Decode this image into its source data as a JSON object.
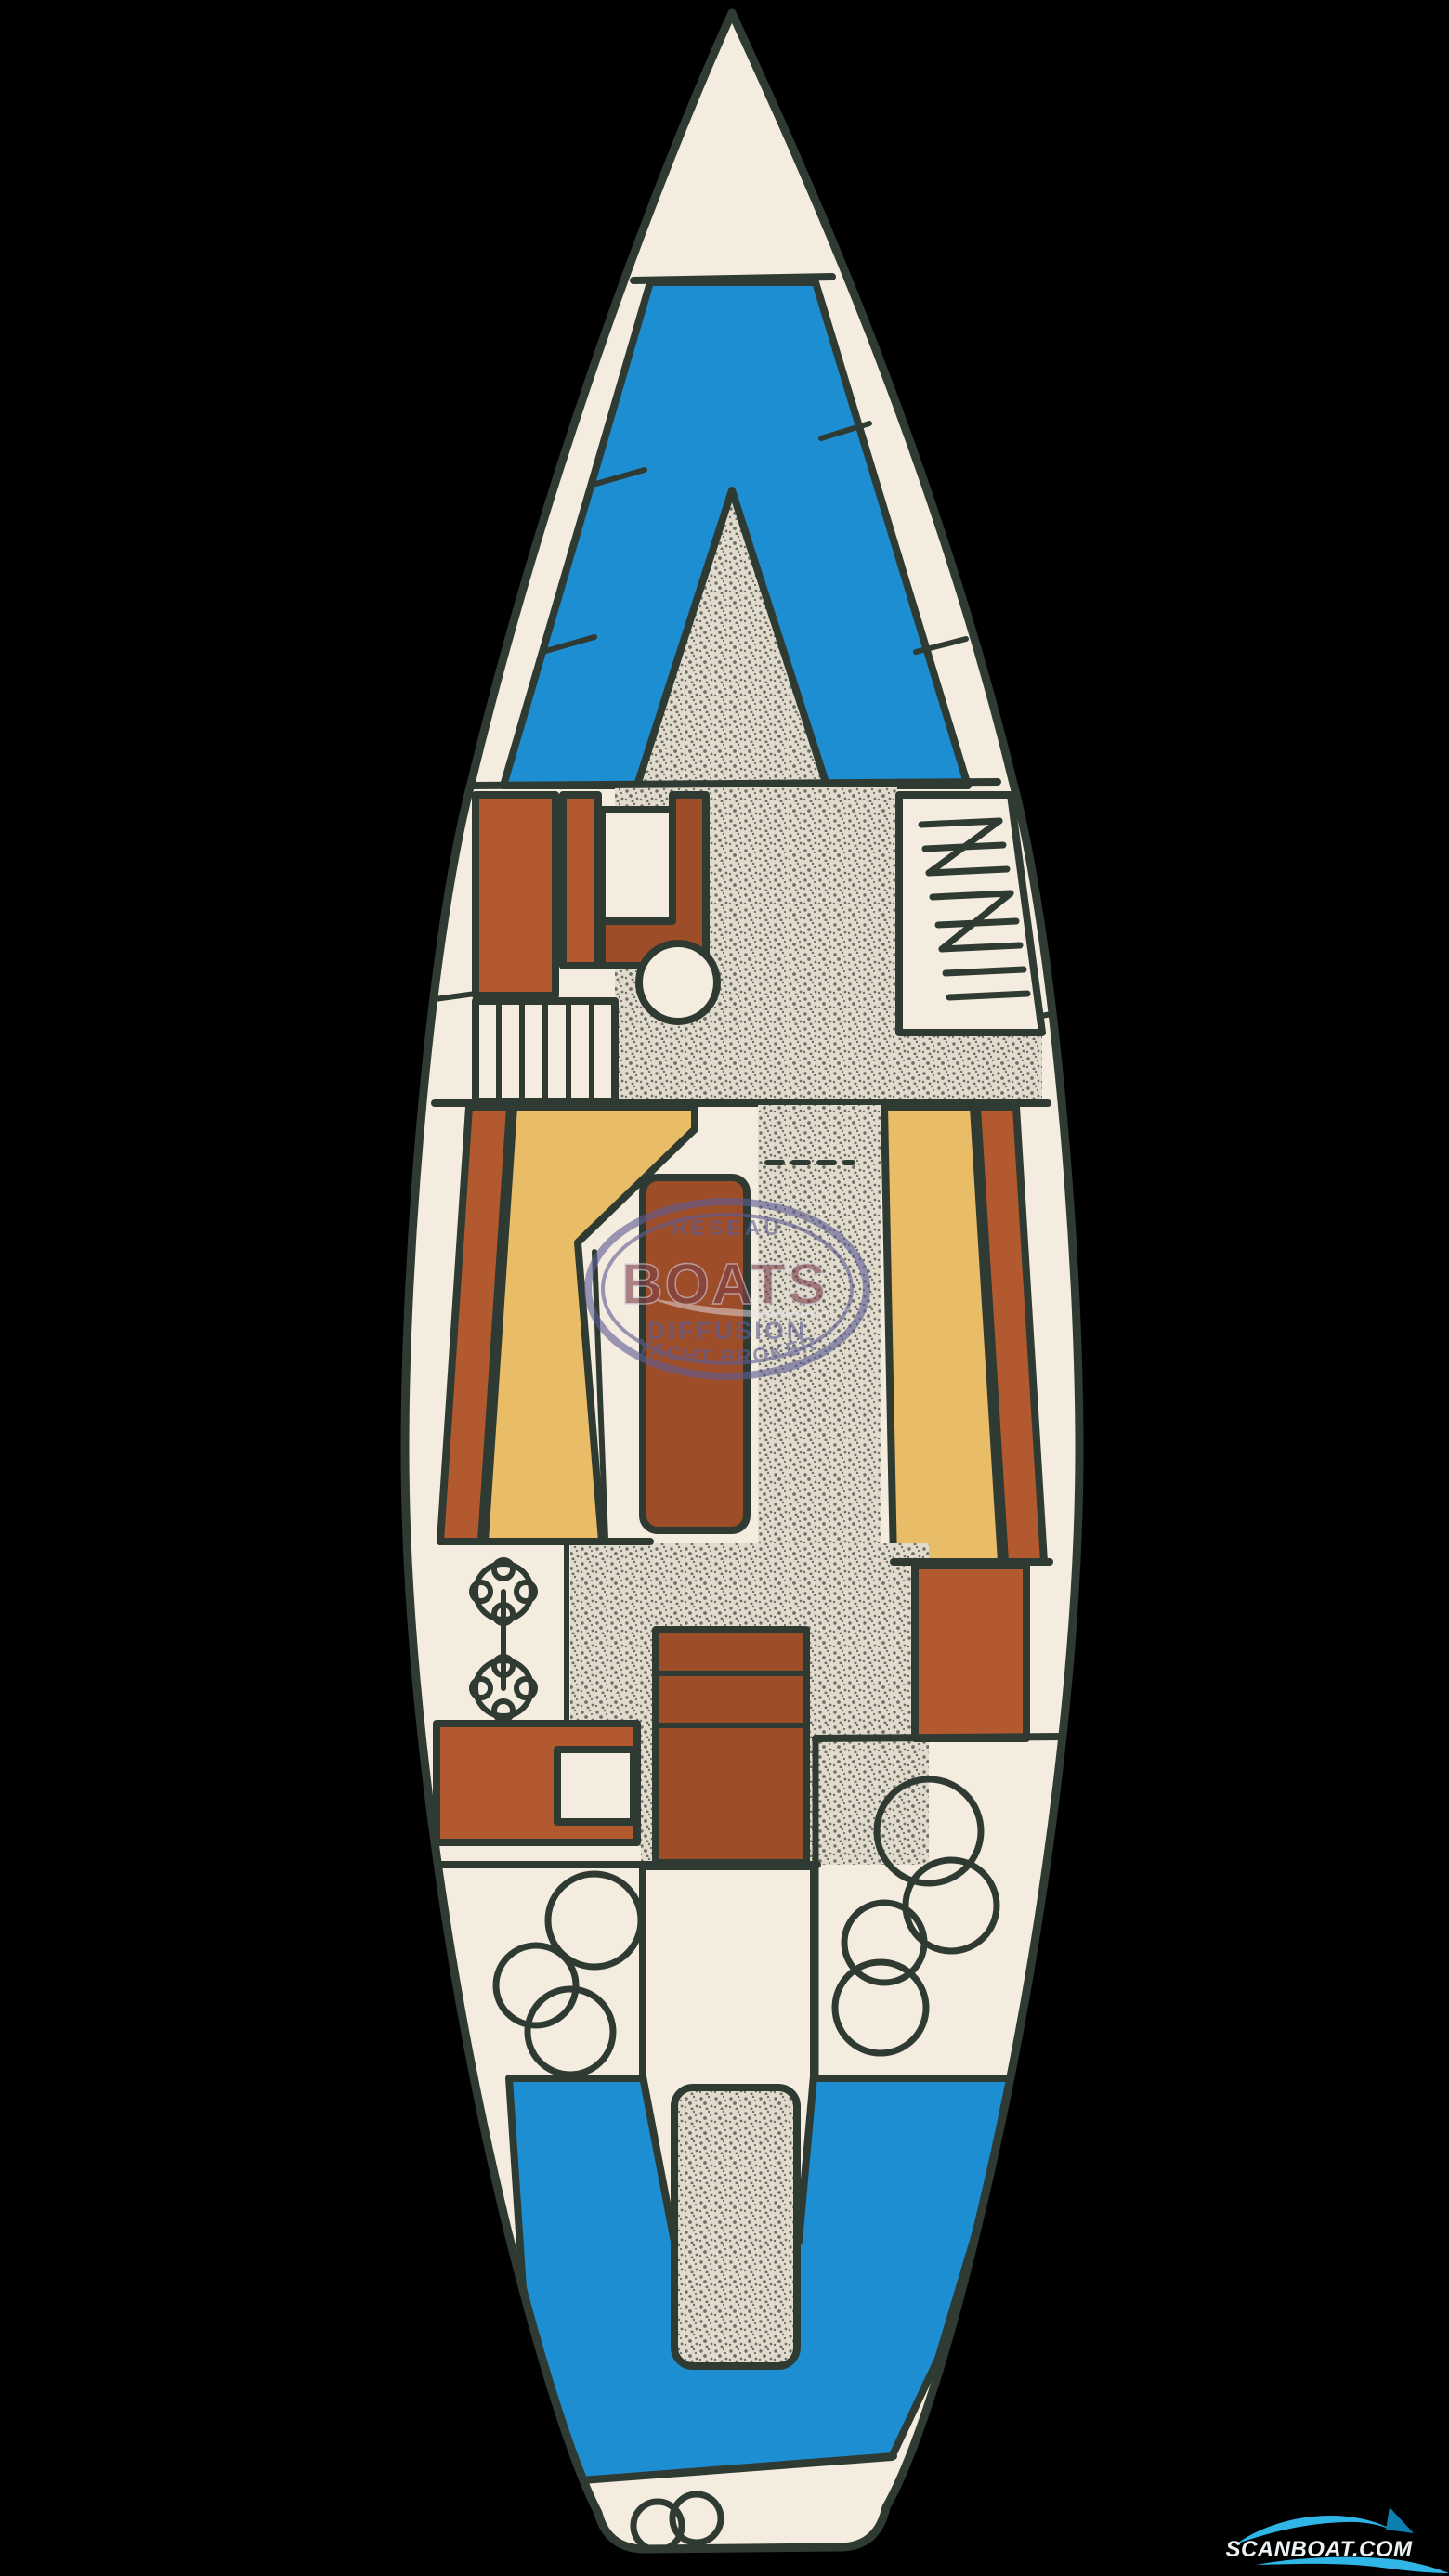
{
  "watermark": {
    "line1": "RESEAU",
    "brand": "BOATS",
    "line3": "DIFFUSION",
    "line4": "YACHT BROKER"
  },
  "logo": {
    "text": "SCANBOAT.COM"
  },
  "colors": {
    "background": "#000000",
    "outline": "#2f3b32",
    "hull": "#f3ecdf",
    "deck_blue": "#1e8ed2",
    "wood_rust": "#b2592f",
    "wood_rust_dark": "#9d4d28",
    "cushion_tan": "#e9bc67",
    "sole_base": "#e0dbcd",
    "sole_dot": "#6e6e64",
    "watermark_purple": "#5f5d95",
    "watermark_maroon": "#7d4048",
    "watermark_swoosh": "#e8e4ee",
    "scanboat_cyan": "#2fb6e6",
    "scanboat_cyan_dark": "#0d7fae",
    "scanboat_text": "#eef2f4"
  }
}
